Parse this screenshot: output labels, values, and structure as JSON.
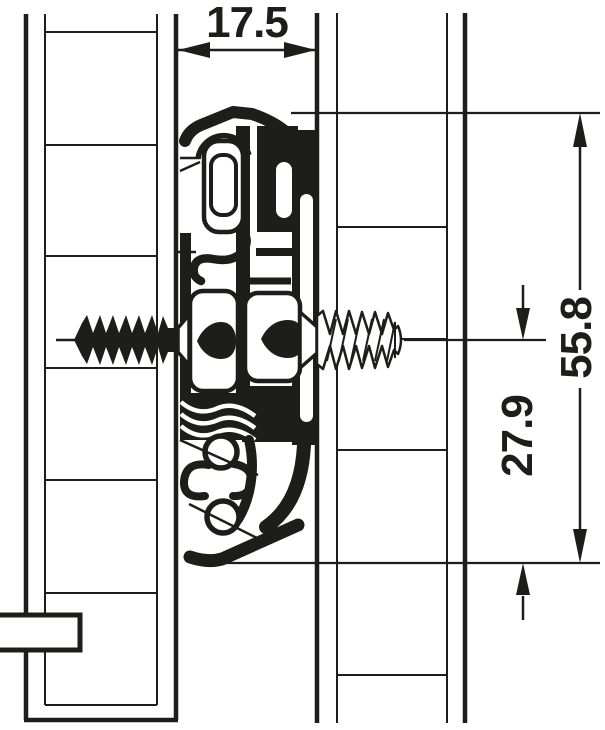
{
  "drawing": {
    "kind": "technical-cross-section-drawer-slide",
    "dimensions": {
      "slide_width": "17.5",
      "slide_height_total": "55.8",
      "screw_axis_to_bottom": "27.9"
    },
    "colors": {
      "line": "#1d1d1b",
      "background": "#ffffff"
    }
  }
}
